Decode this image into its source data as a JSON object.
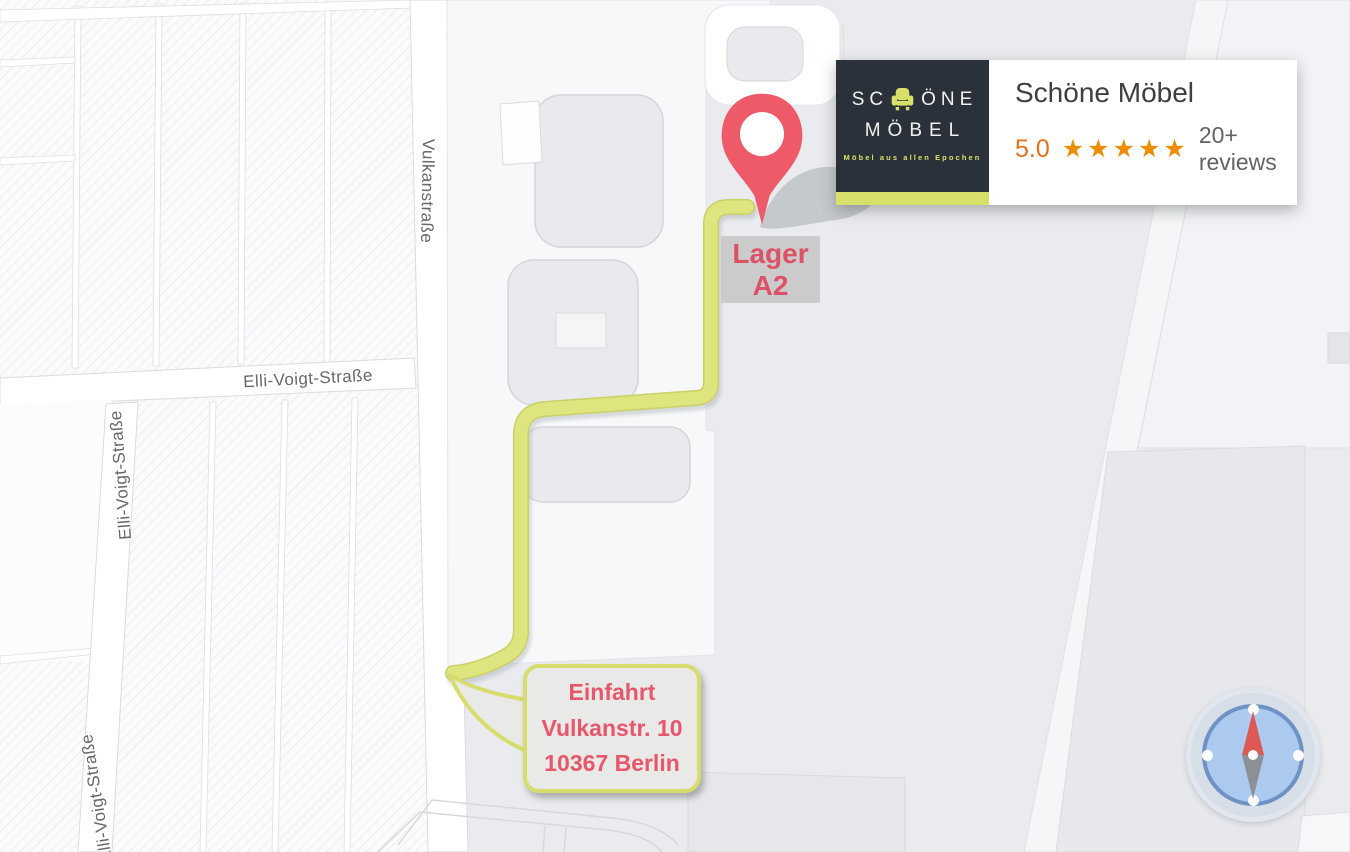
{
  "map": {
    "streets": {
      "vulkanstrasse": "Vulkanstraße",
      "elli_voigt_h": "Elli-Voigt-Straße",
      "elli_voigt_left": "Elli-Voigt-Straße",
      "elli_voigt_bottom": "Elli-Voigt-Straße"
    },
    "marker_label": {
      "line1": "Lager",
      "line2": "A2"
    },
    "bubble": {
      "line1": "Einfahrt",
      "line2": "Vulkanstr. 10",
      "line3": "10367 Berlin"
    }
  },
  "business_card": {
    "logo": {
      "line1_pre": "SC",
      "line1_post": "ÖNE",
      "line2": "MÖBEL",
      "tagline": "Möbel aus allen Epochen"
    },
    "title": "Schöne Möbel",
    "rating": {
      "score": "5.0",
      "stars": "★★★★★",
      "reviews": "20+ reviews"
    }
  },
  "colors": {
    "route_green": "#dfe57e",
    "route_edge": "#c9d065",
    "pin_red": "#ee5a68",
    "marker_label_red": "#dd5166",
    "bubble_text_red": "#e8566b",
    "bubble_border": "#d7dd6c",
    "logo_bg": "#2a313b",
    "logo_accent": "#d9e069",
    "rating_orange": "#e7711b",
    "star_orange": "#ee8d00",
    "compass_face_blue": "#accaf0",
    "compass_ring_blue": "#6e92c3",
    "map_bg": "#e9ebee"
  }
}
